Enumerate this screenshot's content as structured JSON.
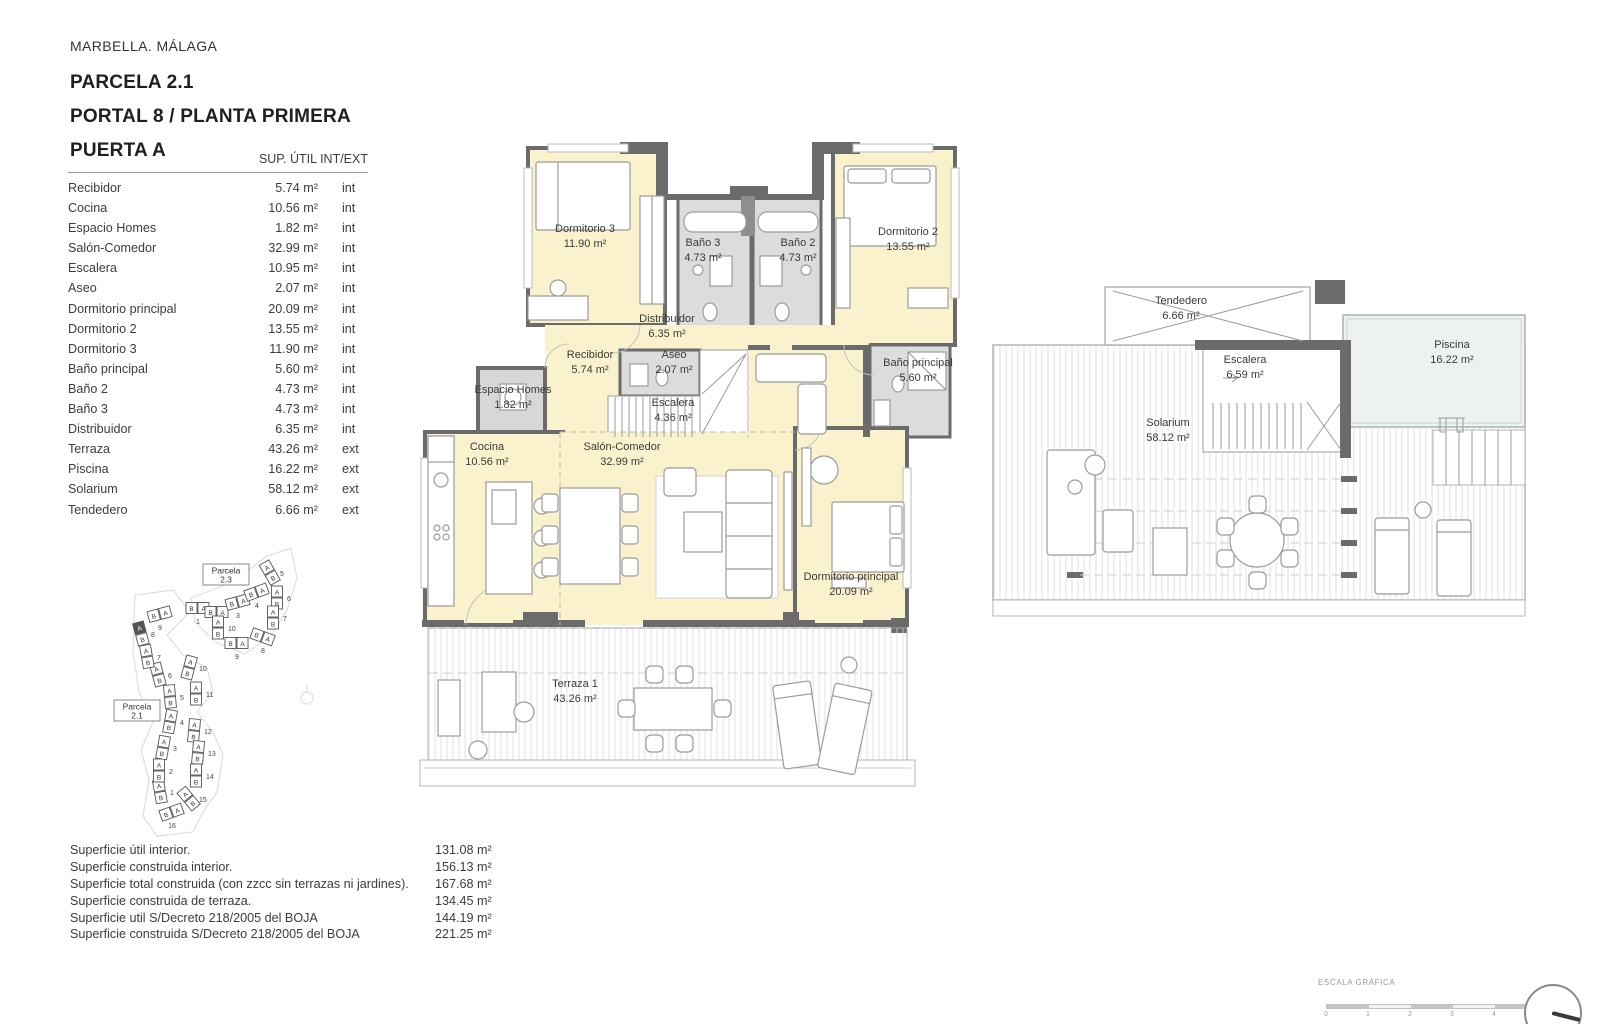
{
  "header": {
    "location": "MARBELLA. MÁLAGA",
    "parcela": "PARCELA 2.1",
    "portal": "PORTAL 8 / PLANTA PRIMERA",
    "puerta": "PUERTA A"
  },
  "area_table": {
    "header": "SUP. ÚTIL INT/EXT",
    "rows": [
      {
        "label": "Recibidor",
        "value": "5.74 m²",
        "type": "int"
      },
      {
        "label": "Cocina",
        "value": "10.56 m²",
        "type": "int"
      },
      {
        "label": "Espacio Homes",
        "value": "1.82 m²",
        "type": "int"
      },
      {
        "label": "Salón-Comedor",
        "value": "32.99 m²",
        "type": "int"
      },
      {
        "label": "Escalera",
        "value": "10.95 m²",
        "type": "int"
      },
      {
        "label": "Aseo",
        "value": "2.07 m²",
        "type": "int"
      },
      {
        "label": "Dormitorio principal",
        "value": "20.09 m²",
        "type": "int"
      },
      {
        "label": "Dormitorio 2",
        "value": "13.55 m²",
        "type": "int"
      },
      {
        "label": "Dormitorio 3",
        "value": "11.90 m²",
        "type": "int"
      },
      {
        "label": "Baño principal",
        "value": "5.60 m²",
        "type": "int"
      },
      {
        "label": "Baño 2",
        "value": "4.73 m²",
        "type": "int"
      },
      {
        "label": "Baño 3",
        "value": "4.73 m²",
        "type": "int"
      },
      {
        "label": "Distribuidor",
        "value": "6.35 m²",
        "type": "int"
      },
      {
        "label": "Terraza",
        "value": "43.26 m²",
        "type": "ext"
      },
      {
        "label": "Piscina",
        "value": "16.22 m²",
        "type": "ext"
      },
      {
        "label": "Solarium",
        "value": "58.12 m²",
        "type": "ext"
      },
      {
        "label": "Tendedero",
        "value": "6.66 m²",
        "type": "ext"
      }
    ]
  },
  "summary": {
    "rows": [
      {
        "label": "Superficie útil interior.",
        "value": "131.08 m²"
      },
      {
        "label": "Superficie construida interior.",
        "value": "156.13 m²"
      },
      {
        "label": "Superficie total construida (con zzcc sin terrazas ni jardines).",
        "value": "167.68 m²"
      },
      {
        "label": "Superficie construida de terraza.",
        "value": "134.45 m²"
      },
      {
        "label": "Superficie util S/Decreto 218/2005 del BOJA",
        "value": "144.19 m²"
      },
      {
        "label": "Superficie construida S/Decreto 218/2005 del BOJA",
        "value": "221.25 m²"
      }
    ]
  },
  "plans": {
    "main": {
      "rooms": {
        "dormitorio3": {
          "name": "Dormitorio 3",
          "area": "11.90 m²"
        },
        "bano3": {
          "name": "Baño 3",
          "area": "4.73 m²"
        },
        "bano2": {
          "name": "Baño 2",
          "area": "4.73 m²"
        },
        "dormitorio2": {
          "name": "Dormitorio 2",
          "area": "13.55 m²"
        },
        "distribuidor": {
          "name": "Distribuidor",
          "area": "6.35 m²"
        },
        "recibidor": {
          "name": "Recibidor",
          "area": "5.74 m²"
        },
        "aseo": {
          "name": "Aseo",
          "area": "2.07 m²"
        },
        "escalera": {
          "name": "Escalera",
          "area": "4.36 m²"
        },
        "espacio_homes": {
          "name": "Espacio Homes",
          "area": "1.82 m²"
        },
        "bano_principal": {
          "name": "Baño principal",
          "area": "5.60 m²"
        },
        "cocina": {
          "name": "Cocina",
          "area": "10.56 m²"
        },
        "salon": {
          "name": "Salón-Comedor",
          "area": "32.99 m²"
        },
        "dormitorio_principal": {
          "name": "Dormitorio principal",
          "area": "20.09 m²"
        },
        "terraza": {
          "name": "Terraza 1",
          "area": "43.26 m²"
        }
      }
    },
    "roof": {
      "rooms": {
        "tendedero": {
          "name": "Tendedero",
          "area": "6.66 m²"
        },
        "escalera": {
          "name": "Escalera",
          "area": "6.59 m²"
        },
        "piscina": {
          "name": "Piscina",
          "area": "16.22 m²"
        },
        "solarium": {
          "name": "Solarium",
          "area": "58.12 m²"
        }
      }
    }
  },
  "site_plan": {
    "parcela_23": {
      "name": "Parcela",
      "num": "2.3"
    },
    "parcela_21": {
      "name": "Parcela",
      "num": "2.1"
    },
    "unit_letters": [
      "A",
      "B"
    ],
    "portals_21": [
      "1",
      "2",
      "3",
      "4",
      "5",
      "6",
      "7",
      "8",
      "9",
      "10",
      "11",
      "12",
      "13",
      "14",
      "15",
      "16"
    ],
    "portals_23": [
      "1",
      "2",
      "3",
      "4",
      "5",
      "6",
      "7",
      "8",
      "9",
      "10"
    ],
    "highlighted_portal": "8"
  },
  "scale_bar": {
    "label": "ESCALA GRÁFICA",
    "ticks": [
      "0",
      "1",
      "2",
      "3",
      "4",
      "5m"
    ]
  },
  "colors": {
    "room_fill": "#faf2cc",
    "wet_fill": "#dcdcdc",
    "wall": "#6b6b6b",
    "pool_fill": "#edf2f0"
  }
}
